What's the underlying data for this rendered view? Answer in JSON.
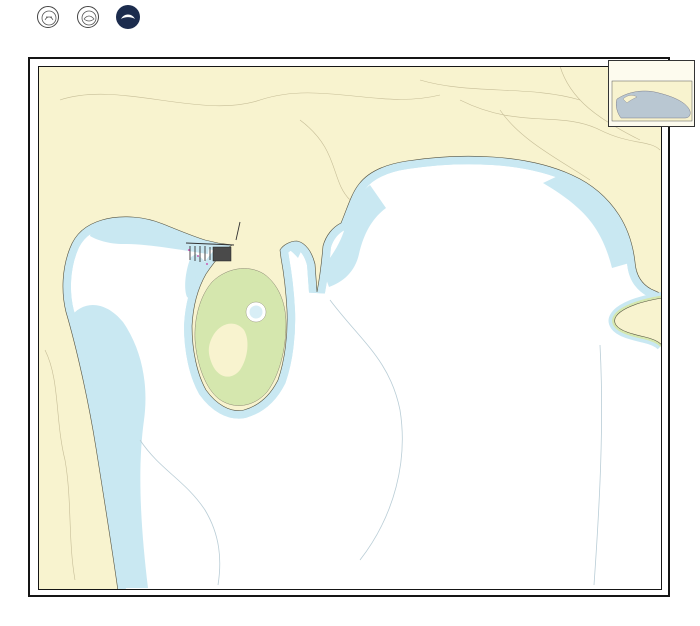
{
  "colors": {
    "magenta": "#c9379f",
    "land": "#f8f3cf",
    "shallow": "#c9e8f2",
    "intertidal": "#d5e7ae",
    "inset_water": "#b9c7d2",
    "ink": "#1b1b1b",
    "sounding": "#3c3c3c"
  },
  "header": {
    "soundings_note": "SOUNDINGS IN FEET",
    "chart_no_side": "18428",
    "logos_caption": "U.S. DEPARTMENT OF COMMERCE — NATIONAL OCEANIC AND ATMOSPHERIC ADMINISTRATION — NATIONAL OCEAN SERVICE",
    "authorities": {
      "x": 207,
      "y": 8,
      "s": 2.1,
      "lines": [
        "AUTHORITIES",
        "Hydrography and topography by the National",
        "Ocean Service, Coast Survey, with additional",
        "data from the Corps of Engineers, Geological",
        "Survey, and U.S. Coast Guard.",
        "",
        "Consult U.S. Coast Guard Light List for",
        "supplemental information on aids to navigation."
      ]
    },
    "projection": {
      "x": 249,
      "y": 10.5,
      "s": 2.2,
      "lines": [
        "Mercator Projection",
        "Scale 1:10,000 at Lat. 48°17'",
        "North American Datum of 1983",
        "(World Geodetic System 1984)",
        "",
        "SOUNDINGS IN FEET",
        "AT MEAN LOWER LOW WATER"
      ]
    },
    "scale_label": "SCALE 1:10,000",
    "scalebar_feet": [
      "1000",
      "500",
      "0",
      "1000",
      "2000",
      "3000"
    ],
    "scalebar_units": [
      "FEET",
      "METERS"
    ],
    "country_line": "UNITED STATES — WEST COAST",
    "state_line": "WASHINGTON",
    "title": "OAK AND CRESCENT HARBORS",
    "title_sub": "SOUNDINGS IN FEET AT MEAN LOWER LOW WATER",
    "heights_note": {
      "x": 489,
      "y": 21,
      "s": 1.9,
      "lines": [
        "Heights in feet above",
        "Mean High Water except",
        "where otherwise noted.",
        "See note on datum."
      ]
    },
    "tide_table": {
      "title": "TIDAL INFORMATION",
      "col_headers": [
        "Place",
        "MHHW",
        "MHW",
        "MLW",
        "ELW"
      ],
      "rows": [
        [
          "Oak Harbor",
          "11.8",
          "11.0",
          "3.4",
          "-4.5"
        ],
        [
          "Crescent Harbor",
          "11.6",
          "10.9",
          "3.3",
          "-4.0"
        ]
      ]
    },
    "pollution_note": {
      "x": 603,
      "y": 7,
      "s": 1.9,
      "lines": [
        "POLLUTION REPORTS",
        "Report all spills of oil and hazardous substances",
        "to the National Response Center via",
        "1-800-424-8802 (toll free), or to the nearest",
        "U.S. Coast Guard facility (33 CFR 153)."
      ]
    },
    "caution_note": {
      "x": 603,
      "y": 22,
      "s": 1.9,
      "lines": [
        "CAUTION",
        "Temporary changes or defects in aids to",
        "navigation are not indicated on this chart.",
        "See Local Notice to Mariners.",
        "",
        "RADAR REFLECTORS",
        "Radar reflectors have been placed on many",
        "floating aids to navigation."
      ]
    }
  },
  "map": {
    "labels": [
      {
        "t": "WHIDBEY ISLAND",
        "x": 443,
        "y": 92,
        "s": 7,
        "ls": 9,
        "c": "#4a4a42",
        "n": "label-whidbey-island"
      },
      {
        "t": "OAK HARBOR",
        "x": 152,
        "y": 197,
        "s": 4.2,
        "ls": 1.5,
        "c": "#3a3a32",
        "n": "label-oak-harbor-town"
      },
      {
        "t": "OAK HARBOR",
        "x": 140,
        "y": 277,
        "s": 5.5,
        "ls": 3.5,
        "it": 1,
        "rot": -42,
        "c": "#3a3a32",
        "n": "label-oak-harbor-bay"
      },
      {
        "t": "CRESCENT HARBOR",
        "x": 441,
        "y": 263,
        "s": 6.5,
        "ls": 5.5,
        "it": 1,
        "c": "#3a3a32",
        "n": "label-crescent-harbor"
      },
      {
        "t": "SARATOGA PASSAGE",
        "x": 626,
        "y": 521,
        "s": 6.5,
        "ls": 3.8,
        "it": 1,
        "rot": -33,
        "c": "#3a3a32",
        "n": "label-saratoga-passage"
      },
      {
        "t": "Scenic Heights",
        "x": 94,
        "y": 450,
        "s": 3.4,
        "c": "#4a4a42",
        "n": "label-scenic-heights"
      },
      {
        "t": "Forbes Point",
        "x": 254,
        "y": 398,
        "s": 3.2,
        "it": 1,
        "c": "#4a4a42",
        "n": "label-forbes-point"
      },
      {
        "t": "(JOINS CHART 18441)",
        "x": 668,
        "y": 470,
        "s": 2.6,
        "rot": -90,
        "c": "#666",
        "n": "label-joins-chart"
      }
    ],
    "water_notes": [
      {
        "x": 438,
        "y": 223,
        "s": 2.8,
        "lines": [
          "REGULATED NAVIGATION AREA",
          "33 CFR 166.1303 (see note A)"
        ]
      },
      {
        "x": 467,
        "y": 501,
        "s": 2.8,
        "lines": [
          "PUGET SOUND",
          "VESSEL TRAFFIC SERVICE AREA",
          "(see note B)"
        ]
      },
      {
        "x": 460,
        "y": 517,
        "s": 2.8,
        "lines": [
          "REGULATED NAVIGATION AREA",
          "33 CFR 166.1303 (see note A)"
        ]
      }
    ],
    "land_notes": [
      {
        "x": 131,
        "y": 77,
        "s": 2.1,
        "c": "#3a3a32",
        "lines": [
          "ABBREVIATIONS",
          "bk black      C can       F fixed      N nun",
          "brg bearing   cor corner  Fl flashing  obstr obstruction",
          "D doubtful    dk dock     G green      PA position approx.",
          "priv private  R red       rky rocky    W white",
          "HEIGHTS in feet above Mean High Water"
        ]
      },
      {
        "x": 136,
        "y": 129,
        "s": 2.1,
        "c": "#c9379f",
        "lines": [
          "Chart and related publications are corrected through the dates shown",
          "Consult Local Notice to Mariners for corrections subsequent to these dates"
        ]
      },
      {
        "x": 139,
        "y": 144,
        "s": 2.1,
        "c": "#c9379f",
        "lines": [
          "NOTE A",
          "Navigation regulations are published in Chapter 2, U.S.",
          "Coast Pilot 7. Additions or revisions to Chapter 2 are",
          "published in the Notice to Mariners. Information concerning",
          "the regulations may be obtained at the Office of the",
          "Commander, 13th Coast Guard District in Seattle, Washington,",
          "or at the Office of the District Engineer, Corps of",
          "Engineers in Seattle, Washington.",
          "Refer to charted regulation section numbers."
        ]
      },
      {
        "x": 284,
        "y": 78,
        "s": 2.1,
        "c": "#c9379f",
        "lines": [
          "NOTE B",
          "The Puget Sound Vessel",
          "Traffic Service area",
          "regulations are contained",
          "in 33 CFR 161. All vessels",
          "over 40 meters and tugs",
          "over 8 meters in length",
          "must participate.",
          "VHF-FM Channel 14."
        ]
      }
    ],
    "border": {
      "top": [
        {
          "t": "122°40'",
          "x": 94
        },
        {
          "t": "39'",
          "x": 186
        },
        {
          "t": "38'",
          "x": 278
        },
        {
          "t": "37'",
          "x": 370
        },
        {
          "t": "36'",
          "x": 462
        },
        {
          "t": "35'",
          "x": 554
        },
        {
          "t": "34'",
          "x": 646
        }
      ],
      "left": [
        {
          "t": "18'",
          "y": 147
        },
        {
          "t": "48°17'",
          "y": 284
        },
        {
          "t": "16'",
          "y": 421
        },
        {
          "t": "15'",
          "y": 558
        }
      ]
    },
    "roses": [
      {
        "cx": 443,
        "cy": 383,
        "r1": 46,
        "r3": 28,
        "star_dy": 24
      },
      {
        "cx": 58,
        "cy": 433,
        "r1": 31,
        "r3": 19,
        "star_dy": 10
      }
    ],
    "stars": [
      {
        "x": 210,
        "y": 237,
        "s": 4
      },
      {
        "x": 188,
        "y": 247,
        "s": 4
      },
      {
        "x": 235,
        "y": 250,
        "s": 4
      }
    ],
    "soundings": {
      "seed": 7,
      "regions": [
        {
          "x1": 330,
          "y1": 175,
          "x2": 648,
          "y2": 332,
          "step": 16,
          "dmin": 8,
          "dmax": 38
        },
        {
          "x1": 300,
          "y1": 336,
          "x2": 652,
          "y2": 452,
          "step": 17,
          "dmin": 22,
          "dmax": 58
        },
        {
          "x1": 135,
          "y1": 455,
          "x2": 652,
          "y2": 583,
          "step": 17,
          "dmin": 32,
          "dmax": 92
        },
        {
          "x1": 74,
          "y1": 248,
          "x2": 215,
          "y2": 296,
          "step": 15,
          "dmin": 1,
          "dmax": 10
        },
        {
          "x1": 100,
          "y1": 300,
          "x2": 185,
          "y2": 430,
          "step": 15,
          "dmin": 2,
          "dmax": 14
        }
      ],
      "exclusions": [
        [
          443,
          383,
          54
        ],
        [
          58,
          433,
          36
        ],
        [
          640,
          314,
          30
        ],
        [
          238,
          300,
          50
        ],
        [
          240,
          375,
          52
        ],
        [
          438,
          225,
          26
        ],
        [
          465,
          512,
          30
        ],
        [
          446,
          310,
          9
        ],
        [
          222,
          262,
          20
        ]
      ]
    }
  },
  "inset": {
    "legend_title": "SOURCE",
    "legend_rows": [
      "A1  1983–1994  NOS Survey — full coverage",
      "A2  1983–1994  NOS Survey — partial coverage",
      "B1  1940–1982  NOS Survey — partial coverage",
      "B2  pre-1940   NOS Survey — partial coverage"
    ],
    "caption": "SOURCE DIAGRAM",
    "note_lines": [
      "The outlined areas represent the extent of the",
      "hydrographic survey data used to compile this chart.",
      "Surveys dated before 1940 or of smaller scale may",
      "not show all seafloor features in the area."
    ]
  },
  "footer": {
    "edition_note": "18th Ed., Feb. 2016",
    "chart_no_left": "18428",
    "chart_no_right": "18428",
    "corrections": [
      "Last Correction: 9/21/2016, Cleared through",
      "LNM: 38/16 (9/20/2016), NM: 39/16 (9/24/2016), CHS: 38/16 (9/20/2016)"
    ],
    "caution_block": {
      "x": 128,
      "y": 605,
      "s": 1.9,
      "lines": [
        "The prudent mariner will not rely solely on any single aid",
        "to navigation, particularly on floating aids. See U.S. Coast",
        "Guard Light List and U.S. Coast Pilot for details.",
        "This chart meets National Ocean Service standards as of the",
        "print date shown. A chart printed on demand after that date",
        "will include all Notice to Mariners corrections."
      ]
    },
    "boxed_note": {
      "x": 208,
      "y": 606.5,
      "s": 1.9,
      "lines": [
        "Additional chart coverage is listed in the Nautical Chart Catalog.",
        "NOAA ENC coverage of this area is also available."
      ]
    },
    "publisher": {
      "x": 330,
      "y": 603.5,
      "s": 1.9,
      "lines": [
        "Published at Washington, D.C.",
        "U.S. DEPARTMENT OF COMMERCE",
        "NATIONAL OCEANIC AND ATMOSPHERIC ADMINISTRATION",
        "NATIONAL OCEAN SERVICE",
        "Office of Coast Survey"
      ]
    },
    "soundings_note": "SOUNDINGS IN FEET",
    "ruler_labels": [
      "FMS",
      "FT",
      "M"
    ],
    "edition_title": "Oak and Crescent Harbors",
    "edition_sub": "18th Ed., Feb. 2016"
  }
}
